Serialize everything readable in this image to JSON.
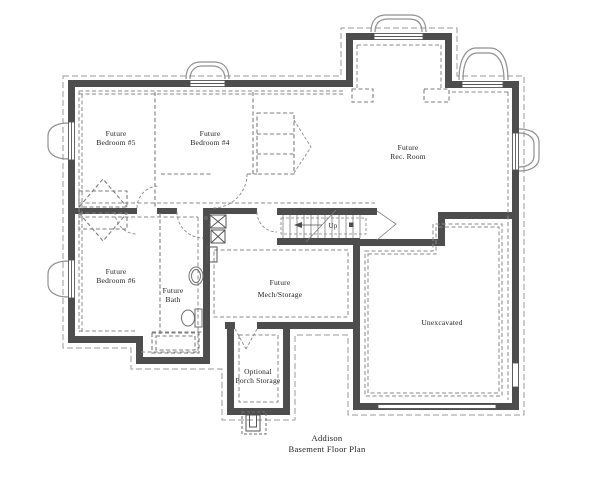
{
  "title": {
    "line1": "Addison",
    "line2": "Basement Floor Plan"
  },
  "rooms": [
    {
      "id": "future-bedroom-5",
      "line1": "Future",
      "line2": "Bedroom #5"
    },
    {
      "id": "future-bedroom-4",
      "line1": "Future",
      "line2": "Bedroom #4"
    },
    {
      "id": "future-rec-room",
      "line1": "Future",
      "line2": "Rec. Room"
    },
    {
      "id": "future-bedroom-6",
      "line1": "Future",
      "line2": "Bedroom #6"
    },
    {
      "id": "future-bath",
      "line1": "Future",
      "line2": "Bath"
    },
    {
      "id": "future-mech-storage",
      "line1": "Future",
      "line2": "Mech/Storage"
    },
    {
      "id": "unexcavated",
      "line1": "Unexcavated",
      "line2": ""
    },
    {
      "id": "optional-porch-storage",
      "line1": "Optional",
      "line2": "Porch Storage"
    }
  ],
  "stairs": {
    "up_label": "Up"
  },
  "colors": {
    "wall": "#4d4d4d",
    "boundary": "#9a9a9a",
    "dashed": "#8a8a8a",
    "future": "#7d7d7d",
    "thin": "#8f8f8f",
    "text": "#1c1c1c"
  }
}
